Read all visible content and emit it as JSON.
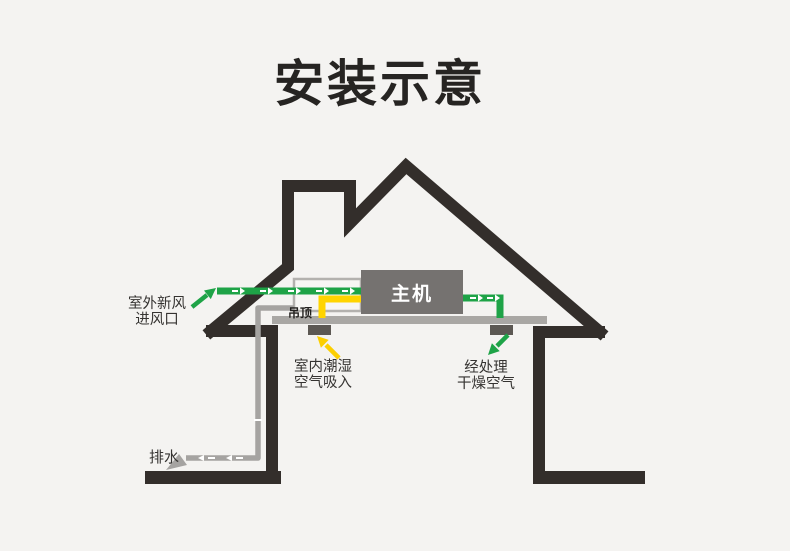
{
  "title": "安装示意",
  "diagram": {
    "unit_label": "主机",
    "ceiling_label": "吊顶",
    "labels": {
      "outdoor_line1": "室外新风",
      "outdoor_line2": "进风口",
      "indoor_line1": "室内潮湿",
      "indoor_line2": "空气吸入",
      "treated_line1": "经处理",
      "treated_line2": "干燥空气",
      "drain": "排水"
    },
    "colors": {
      "background": "#f4f3f1",
      "house_outline": "#332e2b",
      "fresh_air_green": "#1ea347",
      "humid_air_yellow": "#ffd400",
      "drain_gray": "#a5a3a1",
      "unit_gray": "#757270",
      "ceiling_gray": "#a9a7a4",
      "vent_gray": "#5c5853",
      "text": "#353331"
    }
  }
}
